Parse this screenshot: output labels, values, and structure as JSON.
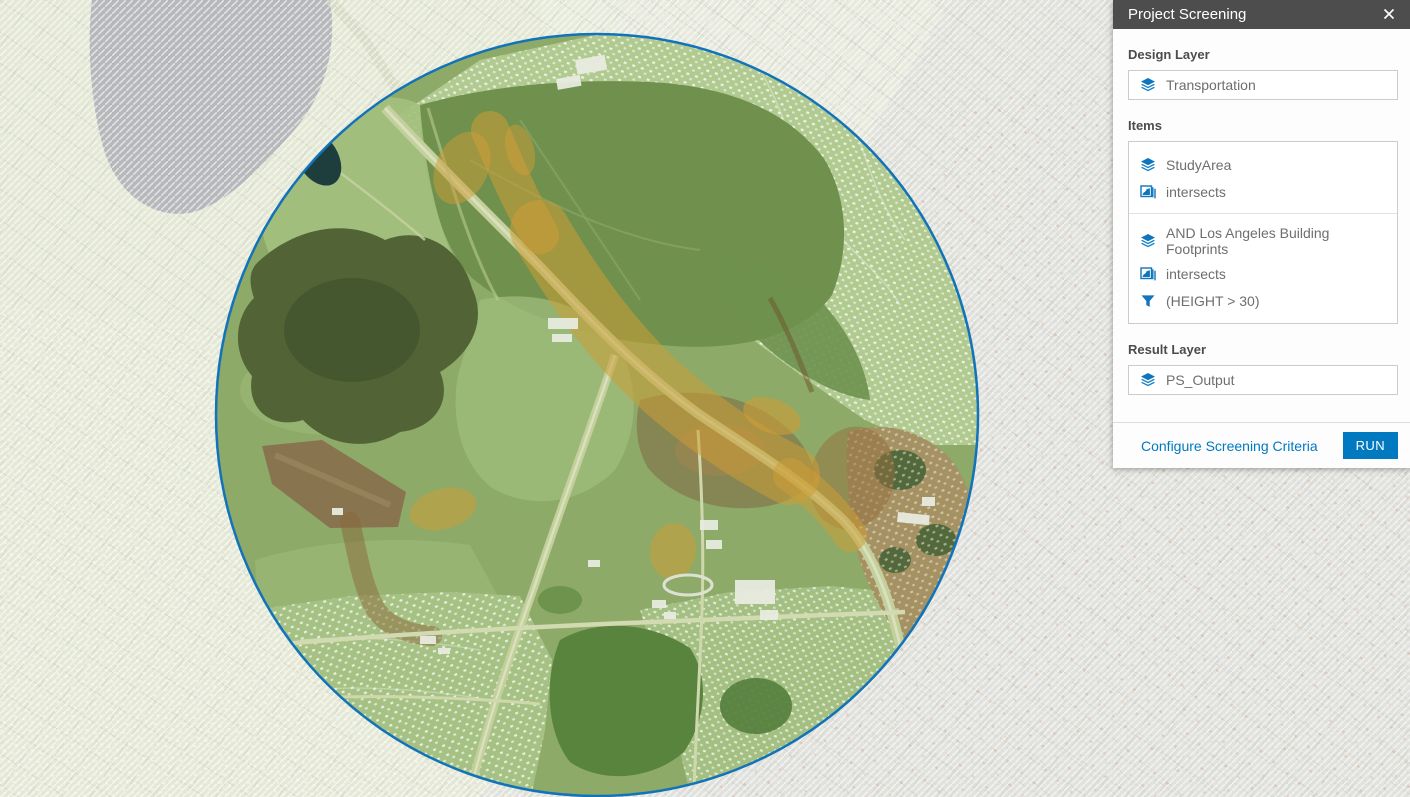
{
  "panel": {
    "title": "Project Screening",
    "design_layer": {
      "label": "Design Layer",
      "value": "Transportation"
    },
    "items": {
      "label": "Items",
      "groups": [
        {
          "layer": "StudyArea",
          "relation": "intersects"
        },
        {
          "layer": "AND Los Angeles Building Footprints",
          "relation": "intersects",
          "filter": "(HEIGHT > 30)"
        }
      ]
    },
    "result_layer": {
      "label": "Result Layer",
      "value": "PS_Output"
    },
    "footer": {
      "configure_link": "Configure Screening Criteria",
      "run_button": "RUN"
    }
  },
  "map": {
    "colors": {
      "accent_blue": "#0079c1",
      "panel_header_bg": "#4d4d4d",
      "study_circle_outline": "#1273b9",
      "screening_overlay_green": "#8fab6a",
      "screening_overlay_orange": "#d79c33",
      "faded_basemap": "#e4e6df"
    }
  }
}
